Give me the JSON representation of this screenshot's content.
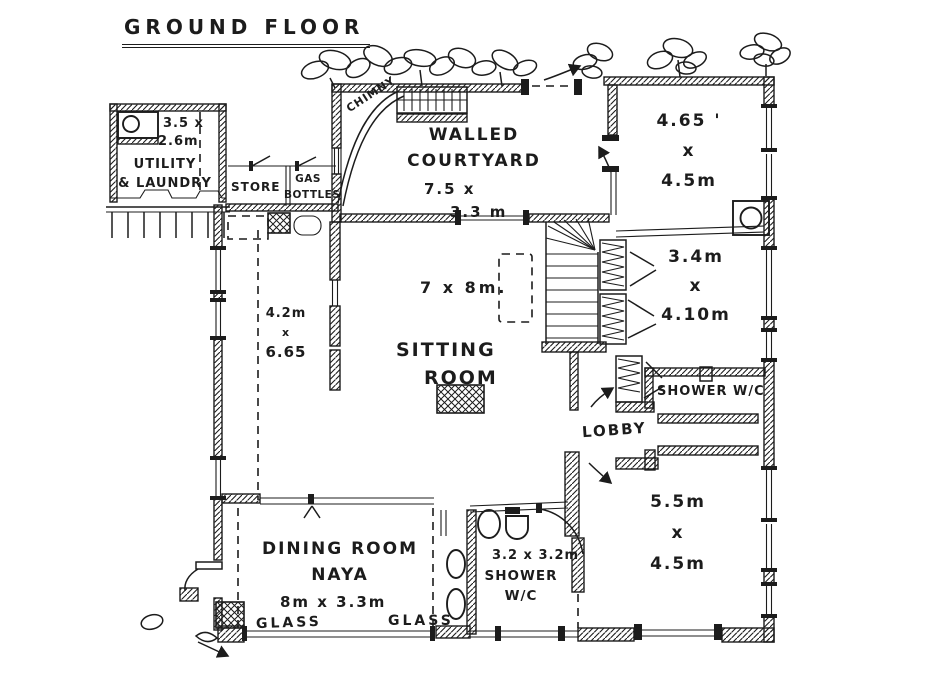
{
  "title": "GROUND FLOOR",
  "colors": {
    "ink": "#1c1c1c",
    "paper": "#ffffff"
  },
  "rooms": {
    "utility": {
      "dims_line1": "3.5 x",
      "dims_line2": "2.6m",
      "name_line1": "UTILITY",
      "name_line2": "& LAUNDRY"
    },
    "store": {
      "name": "STORE"
    },
    "gas_bottles": {
      "name_line1": "GAS",
      "name_line2": "BOTTLES"
    },
    "chimney": {
      "name": "CHIMNY"
    },
    "walled_courtyard": {
      "name_line1": "WALLED",
      "name_line2": "COURTYARD",
      "dims_line1": "7.5 x",
      "dims_line2": "3.3 m"
    },
    "room_ne": {
      "dims_line1": "4.65 '",
      "dims_line2": "x",
      "dims_line3": "4.5m"
    },
    "room_e": {
      "dims_line1": "3.4m",
      "dims_line2": "x",
      "dims_line3": "4.10m"
    },
    "sitting_room": {
      "dims": "7 x 8m.",
      "name_line1": "SITTING",
      "name_line2": "ROOM"
    },
    "annex": {
      "dims_line1": "4.2m",
      "dims_line2": "x",
      "dims_line3": "6.65"
    },
    "lobby": {
      "name": "LOBBY"
    },
    "shower_wc_east": {
      "name": "SHOWER W/C"
    },
    "room_se": {
      "dims_line1": "5.5m",
      "dims_line2": "x",
      "dims_line3": "4.5m"
    },
    "dining_room": {
      "name_line1": "DINING ROOM",
      "name_line2": "NAYA",
      "dims": "8m x 3.3m"
    },
    "glass_left": {
      "name": "GLASS"
    },
    "glass_right": {
      "name": "GLASS"
    },
    "shower_wc_south": {
      "dims": "3.2 x 3.2m",
      "name_line1": "SHOWER",
      "name_line2": "W/C"
    }
  }
}
